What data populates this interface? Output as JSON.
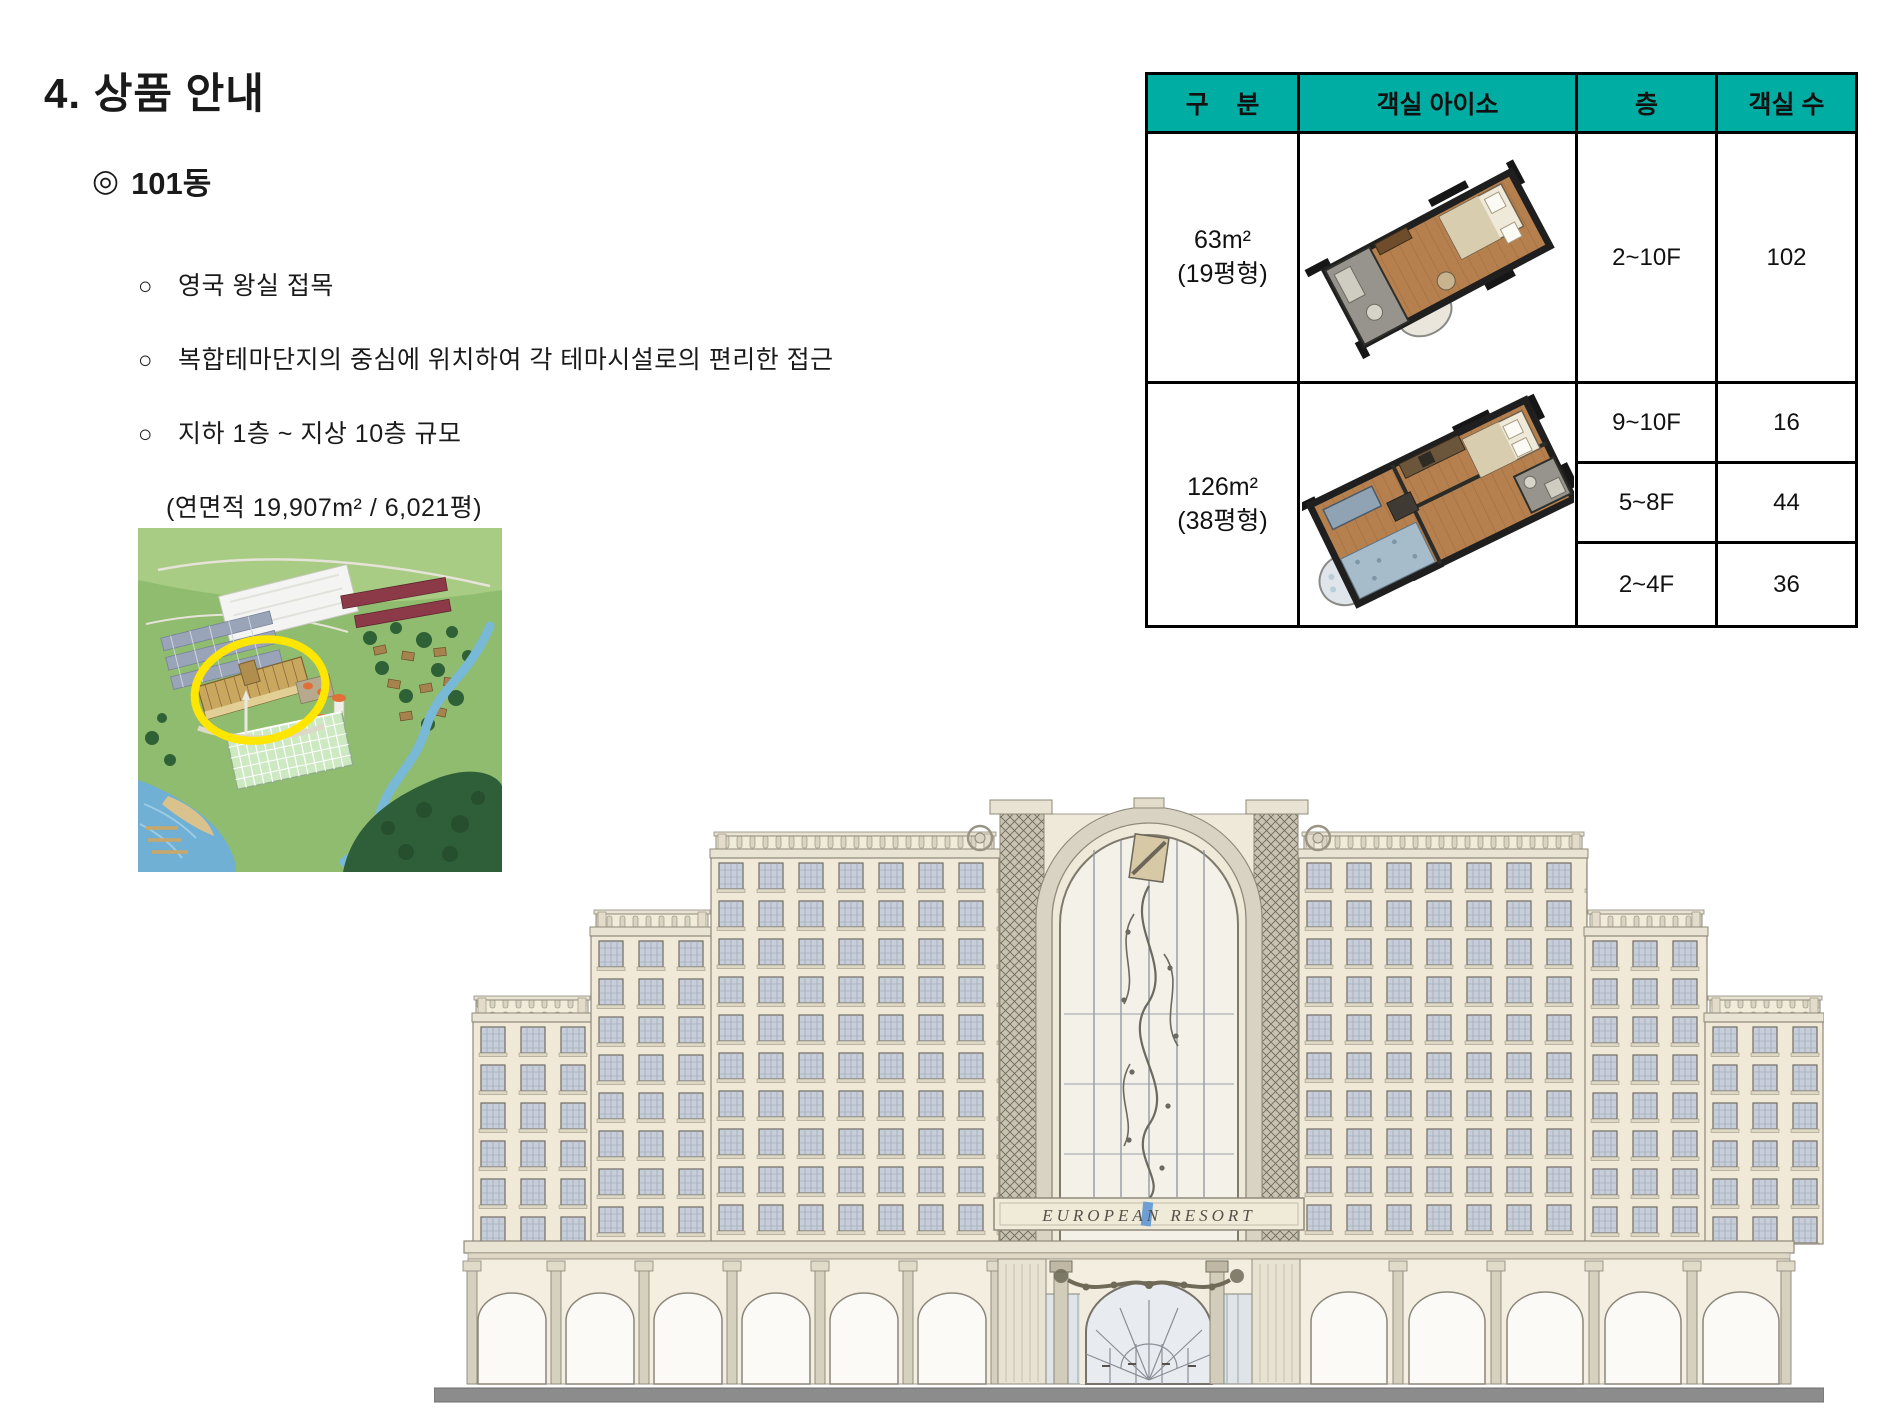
{
  "slide": {
    "title": "4. 상품 안내",
    "section": {
      "marker": "◎",
      "label": "101동"
    }
  },
  "bullets": {
    "items": [
      {
        "m": "○",
        "t": "영국 왕실 접목"
      },
      {
        "m": "○",
        "t": "복합테마단지의 중심에 위치하여 각 테마시설로의 편리한 접근"
      },
      {
        "m": "○",
        "t": "지하 1층 ~ 지상 10층 규모"
      },
      {
        "m": "",
        "t": "(연면적 19,907m² / 6,021평)"
      },
      {
        "m": "○",
        "t": "객실 수 – 총 198실"
      }
    ]
  },
  "table": {
    "headers": [
      "구    분",
      "객실 아이소",
      "층",
      "객실 수"
    ],
    "groups": [
      {
        "area": "63m²",
        "pyeong": "(19평형)",
        "image": "isometric-room-63sqm",
        "rows": [
          {
            "floor": "2~10F",
            "rooms": "102"
          }
        ]
      },
      {
        "area": "126m²",
        "pyeong": "(38평형)",
        "image": "isometric-room-126sqm",
        "rows": [
          {
            "floor": "9~10F",
            "rooms": "16"
          },
          {
            "floor": "5~8F",
            "rooms": "44"
          },
          {
            "floor": "2~4F",
            "rooms": "36"
          }
        ]
      }
    ]
  },
  "building": {
    "banner": "EUROPEAN RESORT"
  },
  "images": {
    "site_map": "aerial-resort-site-map-with-yellow-circle-highlight"
  },
  "colors": {
    "table_header_bg": "#00ADA2",
    "highlight_circle": "#FFE600",
    "facade_cream": "#F0E9D8",
    "ground_strip": "#8C8C8C"
  }
}
